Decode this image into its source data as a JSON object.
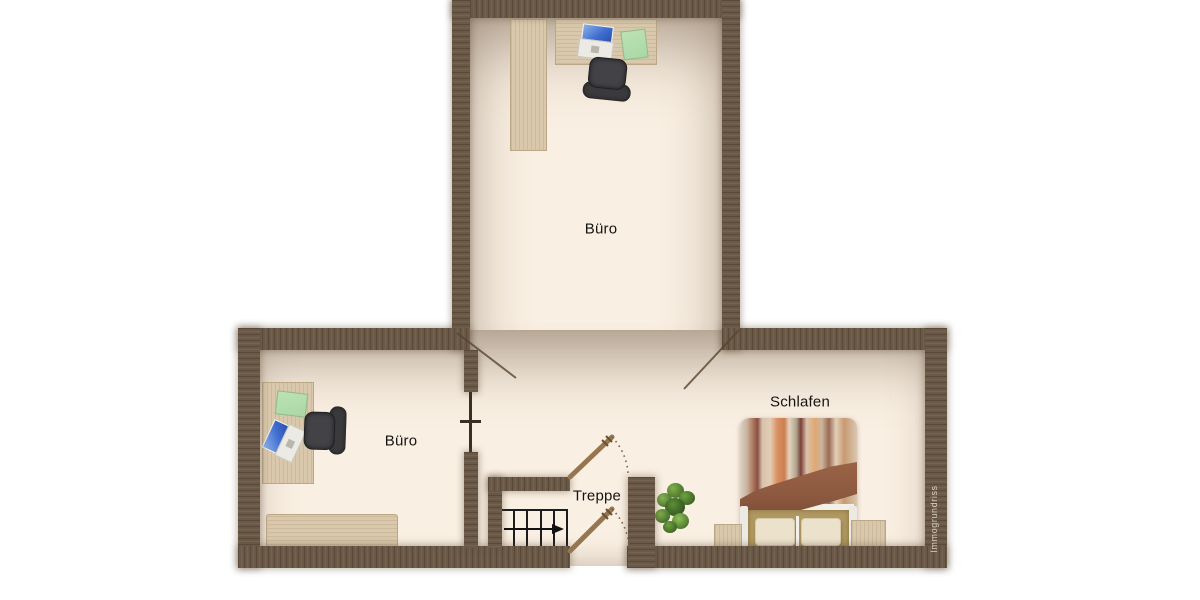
{
  "plan": {
    "watermark": "Immogrundriss",
    "rooms": {
      "office_top": {
        "label": "Büro"
      },
      "office_left": {
        "label": "Büro"
      },
      "stairs": {
        "label": "Treppe"
      },
      "bedroom": {
        "label": "Schlafen"
      }
    }
  },
  "colors": {
    "wall": "#6b5947",
    "floor": "#f9efe2",
    "wood": "#d9c8ab",
    "door": "#96764e",
    "stair_line": "#1c1c1c",
    "chair": "#3a3a3c",
    "laptop_screen": "#3f6fd1",
    "pad": "#a9d8a4",
    "plant": "#4e7d31",
    "bed_blanket": "#8a573e",
    "bed_base": "#b29a62",
    "pillow": "#ece2cc",
    "watermark_color": "#d6cdc1"
  }
}
